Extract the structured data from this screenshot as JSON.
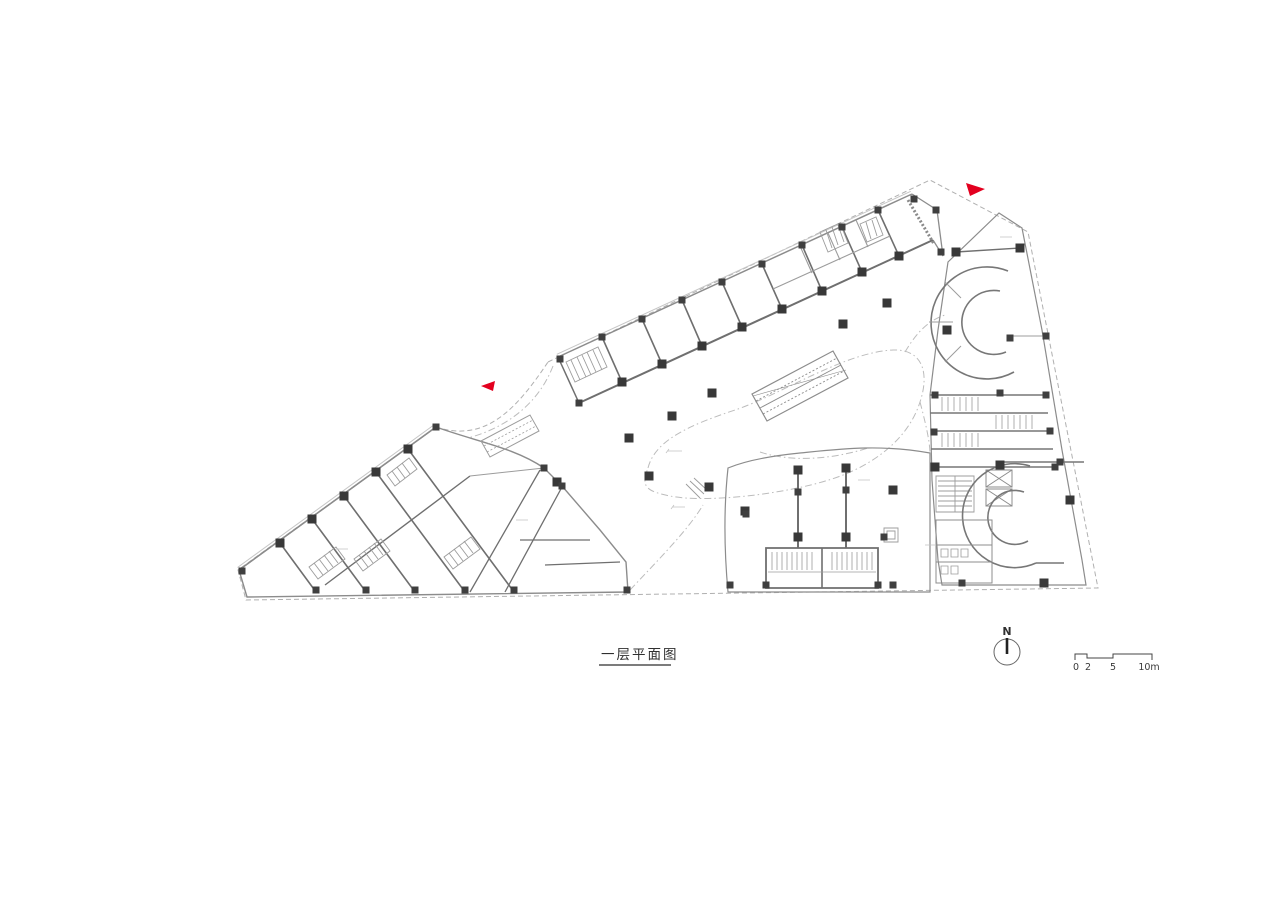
{
  "document": {
    "type": "architectural-floor-plan",
    "plan_title": "一层平面图",
    "north_arrow_label": "N",
    "scale_labels": [
      "0",
      "2",
      "5",
      "10m"
    ],
    "colors": {
      "background": "#ffffff",
      "wall_line": "#6f6f6f",
      "light_line": "#9c9c9c",
      "column_fill": "#383838",
      "site_boundary": "#b0b0b0",
      "plaza_outline": "#bcbcbc",
      "entrance_marker_red": "#e3001f",
      "text": "#2f2f2f"
    },
    "markers": {
      "entrance_arrow_left": "red-triangle",
      "entrance_arrow_top_right": "red-triangle"
    }
  }
}
